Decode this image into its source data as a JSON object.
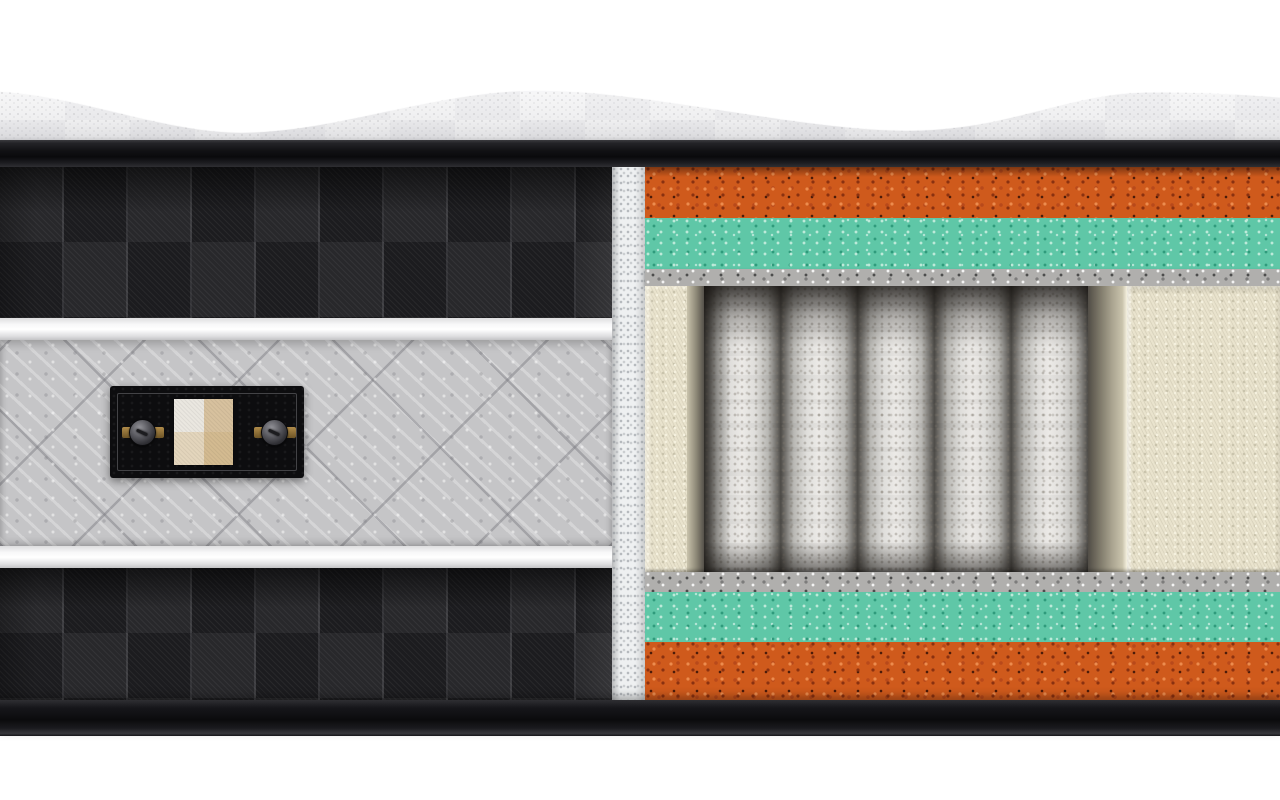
{
  "scene": {
    "subject": "mattress-cross-section-cutaway",
    "description": "3D product render of a hybrid mattress with the right half cut away to reveal internal layers; left half shows the black checkered side fabric with a gray quilted border band and a black fabric swatch label; no text is visible anywhere in the image",
    "background_color": "#ffffff"
  },
  "colors": {
    "background": "#ffffff",
    "top_fabric": "#f2f2f3",
    "top_fabric_shade": "#c9c9cb",
    "piping": "#121215",
    "checker_dark": "#1c1c1f",
    "checker_light": "#28282b",
    "white_bar": "#f4f4f5",
    "quilt": "#c5c5c7",
    "label_bg": "#0d0d0f",
    "swatch_tl": "#eae7e0",
    "swatch_tr": "#d7c19e",
    "swatch_bl": "#e3d5bc",
    "swatch_br": "#d3ba90",
    "strip_white": "#eef0f1",
    "orange": "#cf5a1c",
    "orange_dark": "#8a3110",
    "orange_light": "#ec8c4e",
    "teal": "#5fc7a7",
    "teal_dark": "#2f9b7c",
    "teal_light": "#bdead9",
    "felt": "#b0afad",
    "cream": "#e9e3cd",
    "cream_shadow": "#c9c3ac",
    "cream_highlight": "#f5f1df",
    "spring": "#e2e1de"
  },
  "top_cover": {
    "name": "quilted-top-cover",
    "shape": "wavy pillow-top surface with two dips and two crests",
    "wave_points_px": [
      [
        0,
        91
      ],
      [
        225,
        132
      ],
      [
        530,
        90
      ],
      [
        895,
        130
      ],
      [
        1140,
        92
      ],
      [
        1280,
        97
      ]
    ]
  },
  "side_panel": {
    "bands_top_to_bottom": [
      {
        "name": "checkered-fabric-band",
        "pattern": "black checkerboard twill, squares ~64x75px"
      },
      {
        "name": "white-piping-bar"
      },
      {
        "name": "gray-quilted-border-band",
        "pattern": "diamond quilting ~95px spacing"
      },
      {
        "name": "white-piping-bar"
      },
      {
        "name": "checkered-fabric-band",
        "pattern": "black checkerboard twill"
      }
    ],
    "label": {
      "name": "fabric-swatch-label",
      "shape": "black rectangle with stitched inner border",
      "rivet_count": 2,
      "swatch_quadrant_colors": [
        "#eae7e0",
        "#d7c19e",
        "#e3d5bc",
        "#d3ba90"
      ]
    }
  },
  "cutaway": {
    "layers_top_to_bottom": [
      {
        "name": "comfort-foam",
        "color": "#cf5a1c",
        "thickness_px": 51
      },
      {
        "name": "transition-foam",
        "color": "#5fc7a7",
        "thickness_px": 51
      },
      {
        "name": "felt-insulator-pad",
        "color": "#b0afad",
        "thickness_px": 17
      },
      {
        "name": "pocket-spring-core",
        "color": "#e2e1de",
        "thickness_px": 286,
        "visible_coil_count": 5
      },
      {
        "name": "felt-insulator-pad",
        "color": "#b0afad",
        "thickness_px": 20
      },
      {
        "name": "transition-foam",
        "color": "#5fc7a7",
        "thickness_px": 50
      },
      {
        "name": "base-foam",
        "color": "#cf5a1c",
        "thickness_px": 58
      }
    ],
    "edge_support": {
      "name": "foam-encasement-rail",
      "color": "#e9e3cd",
      "positions": [
        "left",
        "right"
      ]
    }
  }
}
